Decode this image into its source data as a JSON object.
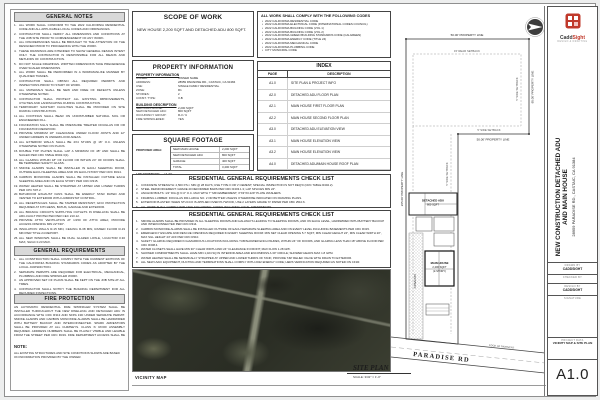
{
  "left_column": {
    "general_notes_title": "GENERAL NOTES",
    "general_notes": [
      "ALL WORK SHALL CONFORM TO THE 2022 CALIFORNIA RESIDENTIAL CODE AND ALL APPLICABLE LOCAL CODES AND ORDINANCES.",
      "CONTRACTOR SHALL VERIFY ALL DIMENSIONS AND CONDITIONS AT THE JOB SITE PRIOR TO COMMENCEMENT OF ANY WORK.",
      "ALL DISCREPANCIES SHALL BE BROUGHT TO THE ATTENTION OF THE DESIGNER PRIOR TO PROCEEDING WITH THE WORK.",
      "THESE DRAWINGS ARE INTENDED TO SHOW GENERAL DESIGN INTENT ONLY. THE CONTRACTOR IS RESPONSIBLE FOR ALL MEANS AND METHODS OF CONSTRUCTION.",
      "DO NOT SCALE DRAWINGS. WRITTEN DIMENSIONS TAKE PRECEDENCE OVER SCALED DIMENSIONS.",
      "ALL WORK SHALL BE PERFORMED IN A WORKMANLIKE MANNER BY QUALIFIED TRADES.",
      "CONTRACTOR SHALL OBTAIN ALL REQUIRED PERMITS AND INSPECTIONS PRIOR TO START OF WORK.",
      "ALL MATERIALS SHALL BE NEW AND FREE OF DEFECTS UNLESS OTHERWISE NOTED.",
      "CONTRACTOR SHALL PROTECT ALL EXISTING IMPROVEMENTS, UTILITIES AND LANDSCAPING DURING CONSTRUCTION.",
      "TEMPORARY SANITARY FACILITIES SHALL BE PROVIDED ON SITE DURING CONSTRUCTION.",
      "ALL FOOTINGS SHALL BEAR ON UNDISTURBED NATURAL SOIL OR ENGINEERED FILL.",
      "FOUNDATION SILLS SHALL BE PRESSURE TREATED DOUGLAS FIR OR FOUNDATION REDWOOD.",
      "PROVIDE MINIMUM 18\" CLEARANCE UNDER FLOOR JOISTS AND 12\" UNDER GIRDERS IN UNDERFLOOR AREAS.",
      "ALL EXTERIOR WALLS SHALL BE 2X4 STUDS @ 16\" O.C. UNLESS OTHERWISE NOTED ON PLANS.",
      "DOUBLE TOP PLATES SHALL LAP A MINIMUM OF 48\" AND SHALL BE NAILED PER CRC TABLE R602.3(1).",
      "ALL GLAZING WITHIN 18\" OF FLOOR OR WITHIN 24\" OF DOORS SHALL BE TEMPERED SAFETY GLASS.",
      "SMOKE ALARMS SHALL BE INSTALLED IN EACH SLEEPING ROOM, OUTSIDE EACH SLEEPING AREA AND ON EACH STORY PER CRC R314.",
      "CARBON MONOXIDE ALARMS SHALL BE INSTALLED OUTSIDE EACH SLEEPING AREA AND ON EACH STORY PER CRC R315.",
      "WATER HEATER SHALL BE STRAPPED AT UPPER AND LOWER THIRDS PER CPC 507.2.",
      "BATHROOM EXHAUST FANS SHALL BE ENERGY STAR RATED AND VENTED TO EXTERIOR WITH HUMIDISTAT CONTROL.",
      "ALL RECEPTACLES SHALL BE TAMPER RESISTANT; GFCI PROTECTION REQUIRED AT KITCHENS, BATHS, GARAGE AND EXTERIOR.",
      "ALL BRANCH CIRCUITS SUPPLYING OUTLETS IN DWELLING SHALL BE ARC-FAULT PROTECTED PER CEC 210.12.",
      "PROVIDE ATTIC VENTILATION AT 1/150 OF ATTIC AREA; PROVIDE ACCESS OPENING MIN 22\"X30\".",
      "INSULATION: WALLS R-15 MIN, CEILING R-38 MIN, RAISED FLOOR R-19 MIN PER TITLE 24 REPORT.",
      "ALL NEW WINDOWS SHALL BE DUAL GLAZED LOW-E, U-FACTOR 0.30 MAX, SHGC 0.23 MAX.",
      "FINISH GRADE SHALL SLOPE AWAY FROM FOUNDATION MIN 5% FOR 10 FEET OR PER CRC R401.3."
    ],
    "general_requirements_title": "GENERAL REQUIREMENTS",
    "general_requirements": [
      "ALL CONSTRUCTION SHALL COMPLY WITH THE CURRENT EDITIONS OF THE CALIFORNIA BUILDING STANDARDS CODES AS ADOPTED BY THE LOCAL JURISDICTION.",
      "SEPARATE PERMITS ARE REQUIRED FOR ELECTRICAL, MECHANICAL, PLUMBING AND FIRE SPRINKLER WORK.",
      "AN APPROVED SET OF PLANS SHALL BE KEPT ON THE JOB SITE AT ALL TIMES.",
      "CONTRACTOR SHALL NOTIFY THE BUILDING DEPARTMENT FOR ALL REQUIRED INSPECTIONS.",
      "CONSTRUCTION HOURS SHALL COMPLY WITH LOCAL NOISE ORDINANCE REQUIREMENTS.",
      "EROSION CONTROL MEASURES SHALL BE IN PLACE PRIOR TO ANY GRADING ACTIVITY."
    ],
    "fire_protection_title": "FIRE PROTECTION",
    "fire_protection_text": "AN AUTOMATIC RESIDENTIAL FIRE SPRINKLER SYSTEM SHALL BE INSTALLED THROUGHOUT THE NEW DWELLING AND DETACHED ADU IN ACCORDANCE WITH CRC R313 AND NFPA 13D UNDER SEPARATE PERMIT. SMOKE ALARMS AND CARBON MONOXIDE ALARMS SHALL BE HARDWIRED WITH BATTERY BACKUP AND INTERCONNECTED. SPARK ARRESTORS SHALL BE PROVIDED AT ALL CHIMNEYS. CLASS 'A' ROOF ASSEMBLY REQUIRED. ADDRESS NUMBERS SHALL BE PLAINLY VISIBLE AND LEGIBLE FROM THE STREET PER CRC R319. FIRE DEPARTMENT ACCESS SHALL BE MAINTAINED DURING ALL PHASES OF CONSTRUCTION.",
    "note_label": "NOTE:",
    "note_text": "ALL EXISTING STRUCTURES AND SITE CONDITIONS SHOWN ARE BASED ON INFORMATION PROVIDED BY THE OWNER."
  },
  "scope_of_work": {
    "title": "SCOPE OF WORK",
    "text": "NEW HOUSE 2,200 SQFT AND DETACHED ADU 800 SQFT."
  },
  "codes": {
    "title": "ALL WORK SHALL COMPLY WITH THE FOLLOWING CODES",
    "items": [
      "2022 CALIFORNIA RESIDENTIAL CODE",
      "2022 CALIFORNIA ELECTRICAL CODE (INTERNATIONAL CODES COUNCIL)",
      "2022 CALIFORNIA BUILDING CODE (VOL 1)",
      "2022 CALIFORNIA BUILDING CODE (VOL 2)",
      "2022 CALIFORNIA GREEN BUILDING STANDARDS CODE (CALGREEN)",
      "2022 CALIFORNIA ENERGY CODE (TITLE 24)",
      "2022 CALIFORNIA MECHANICAL CODE",
      "2022 CALIFORNIA PLUMBING CODE",
      "CITY MUNICIPAL CODE"
    ]
  },
  "index": {
    "title": "INDEX",
    "page_header": "PAGE",
    "description_header": "DESCRIPTION",
    "rows": [
      {
        "page": "A1.0",
        "desc": "SITE PLAN & PROJECT INFO"
      },
      {
        "page": "A2.0",
        "desc": "DETACHED ADU FLOOR PLAN"
      },
      {
        "page": "A2.1",
        "desc": "MAIN HOUSE FIRST FLOOR PLAN"
      },
      {
        "page": "A2.2",
        "desc": "MAIN HOUSE SECOND FLOOR PLAN"
      },
      {
        "page": "A3.0",
        "desc": "DETACHED ADU ELEVATION VIEW"
      },
      {
        "page": "A3.1",
        "desc": "MAIN HOUSE ELEVATION VIEW"
      },
      {
        "page": "A3.2",
        "desc": "MAIN HOUSE ELEVATION VIEW"
      },
      {
        "page": "A4.0",
        "desc": "DETACHED ADU/MAIN HOUSE ROOF PLAN"
      }
    ]
  },
  "property_information": {
    "title": "PROPERTY INFORMATION",
    "info_subtitle": "PROPERTY INFORMATION",
    "info_rows": [
      {
        "label": "OWNER:",
        "value": "OWNER NAME"
      },
      {
        "label": "ADDRESS:",
        "value": "28959 PARADISE RD., CASTAIC, CA 91384"
      },
      {
        "label": "USE:",
        "value": "SINGLE FAMILY RESIDENTIAL"
      },
      {
        "label": "ZONE:",
        "value": "R1"
      },
      {
        "label": "STORIES:",
        "value": "2"
      },
      {
        "label": "CONST. TYPE:",
        "value": "V-B"
      }
    ],
    "building_subtitle": "BUILDING DESCRIPTION",
    "building_rows": [
      {
        "label": "NEW MAIN HOUSE:",
        "value": "2,200 SQFT"
      },
      {
        "label": "NEW DETACHED ADU:",
        "value": "800 SQFT"
      },
      {
        "label": "OCCUPANCY GROUP:",
        "value": "R-3 / U"
      },
      {
        "label": "FIRE SPRINKLERED:",
        "value": "YES"
      }
    ]
  },
  "square_footage": {
    "title": "SQUARE FOOTAGE",
    "side_label": "PROPOSED AREA:",
    "rows": [
      {
        "label": "NEW MAIN HOUSE",
        "value": "2,200 SQFT"
      },
      {
        "label": "NEW DETACHED ADU",
        "value": "800 SQFT"
      },
      {
        "label": "GARAGE",
        "value": "400 SQFT"
      },
      {
        "label": "TOTAL",
        "value": "3,400 SQFT"
      }
    ],
    "coverage_label": "LOT COVERAGE:",
    "coverage_value": "14.7%"
  },
  "checklist_1": {
    "title": "RESIDENTIAL GENERAL REQUIREMENTS CHECK LIST",
    "items": [
      "CONCRETE STRENGTH: 2,500 P.S.I. MIN @ 28 DAYS; USE TYPE II OR V CEMENT; SPECIAL INSPECTION IS NOT REQ'D (CRC TABLE R402.2).",
      "STEEL REINFORCEMENT: GRADE 40 DEFORMED BARS PER CRC R403.1.3; LAP SPLICES MIN 24\".",
      "ANCHOR BOLTS: 1/2\" DIA @ 6'-0\" O.C. MAX WITH 7\" MIN EMBEDMENT; 3\"X3\"X0.229\" PLATE WASHERS.",
      "FRAMING LUMBER: DOUGLAS FIR-LARCH NO. 2 OR BETTER UNLESS OTHERWISE INDICATED ON FRAMING PLANS.",
      "EXTERIOR PLASTER: WHEN STUCCO IS APPLIED OVER PLYWOOD, USE 2 LAYERS GRADE 'D' PAPER PER CBC 2510.6.",
      "ALL WORK SHALL COMPLY WITH THE FOLLOWING: CODES INCLUDING LOCAL AMENDMENTS."
    ]
  },
  "checklist_2": {
    "title": "RESIDENTIAL GENERAL REQUIREMENTS CHECK LIST",
    "items": [
      "SMOKE ALARMS SHALL BE PROVIDED IN ALL SLEEPING ROOMS AND HALLWAYS LEADING TO SLEEPING ROOMS, AND ON EACH LEVEL, HARDWIRED WITH BATTERY BACKUP AND INTERCONNECTED PER CRC R314.",
      "CARBON MONOXIDE ALARMS SHALL BE INSTALLED OUTSIDE OF EACH SEPARATE SLEEPING AREA AND ON EVERY LEVEL INCLUDING BASEMENTS PER CRC R315.",
      "EMERGENCY ESCAPE AND RESCUE OPENINGS REQUIRED IN EVERY SLEEPING ROOM: MIN NET CLEAR OPENING 5.7 SQFT, MIN CLEAR HEIGHT 24\", MIN CLEAR WIDTH 20\", MAX SILL HEIGHT 44\" AFF PER CRC R310.",
      "SAFETY GLAZING REQUIRED IN HAZARDOUS LOCATIONS INCLUDING TUB/SHOWER ENCLOSURES, WITHIN 24\" OF DOORS, AND GLAZING LESS THAN 18\" ABOVE FLOOR PER CRC R308.4.",
      "WATER CLOSETS SHALL HAVE MIN 30\" CLEAR WIDTH AND 24\" CLEARANCE IN FRONT; MAX FLOW 1.28 GPF.",
      "SHOWER COMPARTMENTS SHALL HAVE MIN 1,024 SQ IN INTERIOR AREA AND ENCOMPASS A 30\" CIRCLE; SHOWER HEADS MAX 1.8 GPM.",
      "WATER HEATER SHALL BE SEISMICALLY STRAPPED AT UPPER AND LOWER THIRDS OF TANK; PROVIDE T&P RELIEF VALVE WITH DRAIN TO EXTERIOR.",
      "ALL NEW HVAC EQUIPMENT, DUCTING AND TERMINATIONS SHALL COMPLY WITH 2022 ENERGY CODE; HERS VERIFICATION REQUIRED AS NOTED ON CF1R."
    ]
  },
  "vicinity_map": {
    "label": "VICINITY MAP"
  },
  "site_plan": {
    "title": "SITE PLAN",
    "scale": "SCALE: 3/32\" = 1'-0\"",
    "road_name": "PARADISE  RD",
    "edge_label": "EDGE OF PAVEMENT",
    "dims": {
      "property_line_top": "50.00'  PROPERTY LINE",
      "property_line_right": "95.00'  PROPERTY LINE",
      "property_line_left": "265.00'  PROPERTY LINE",
      "property_line_step": "50.00'  PROPERTY LINE",
      "rear_setback": "15' REAR SETBACK",
      "side_setback_right": "5' SIDE SETBACK",
      "side_setback_step": "5' SIDE SETBACK",
      "side_setback_strip": "5' SIDE SETBACK"
    },
    "adu_line1": "DETACHED ADU",
    "adu_line2": "800 SQFT",
    "house_line1": "MAIN HOUSE",
    "house_line2": "2,200 SQFT",
    "house_line3": "(2-STORY)",
    "driveway_label": "DRIVEWAY"
  },
  "title_block": {
    "logo_text_1": "Cadd",
    "logo_text_2": "Sight",
    "logo_tagline": "DESIGN & DRAFTING",
    "project_title": "NEW CONSTRUCTION DETACHED ADU AND MAIN HOUSE",
    "project_address": "28959 PARADISE RD., CASTAIC, CA 91384",
    "drawn_by_label": "DRAWN BY",
    "drawn_by_value": "CADDSIGHT",
    "checked_by_label": "CHECKED BY",
    "design_by_label": "DESIGN BY",
    "design_by_value": "CADDSIGHT",
    "signature_label": "SIGNATURE",
    "project_data_label": "PROJECT DATA",
    "project_data_value": "VICINITY MAP & SITE PLAN",
    "sheet_number": "A1.0"
  },
  "colors": {
    "accent_red": "#c0392b",
    "header_gray": "#d9d9d9",
    "aerial_dark": "#2e3129"
  }
}
